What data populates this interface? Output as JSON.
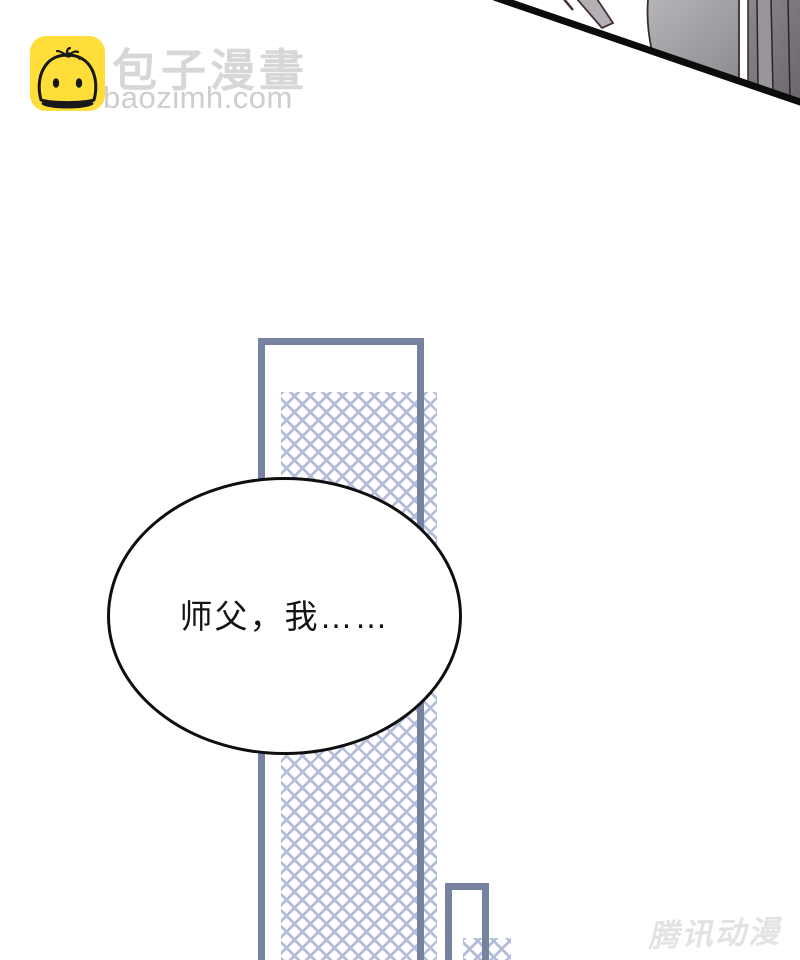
{
  "page": {
    "background_color": "#ffffff",
    "width": 800,
    "height": 960
  },
  "logo": {
    "icon": "baozi-bun-icon",
    "icon_bg_color": "#ffde3a",
    "title": "包子漫畫",
    "title_color": "#d7d7d7",
    "domain": "baozimh.com",
    "domain_color": "#cecece"
  },
  "top_artwork": {
    "name": "character-clothing-hair-fragment",
    "panel_edge_color": "#0c0c0c",
    "fill_colors": [
      "#b2b0b4",
      "#9b999d",
      "#7d7b7f",
      "#69676b"
    ]
  },
  "panel": {
    "border_color": "#76829f",
    "hatch_color": "#b4bedb"
  },
  "speech_bubble": {
    "text": "师父，我……",
    "text_color": "#141414",
    "outline_color": "#0f0f0f",
    "fill_color": "#ffffff"
  },
  "watermark": {
    "text": "腾讯动漫",
    "color": "#e3e3e3"
  }
}
